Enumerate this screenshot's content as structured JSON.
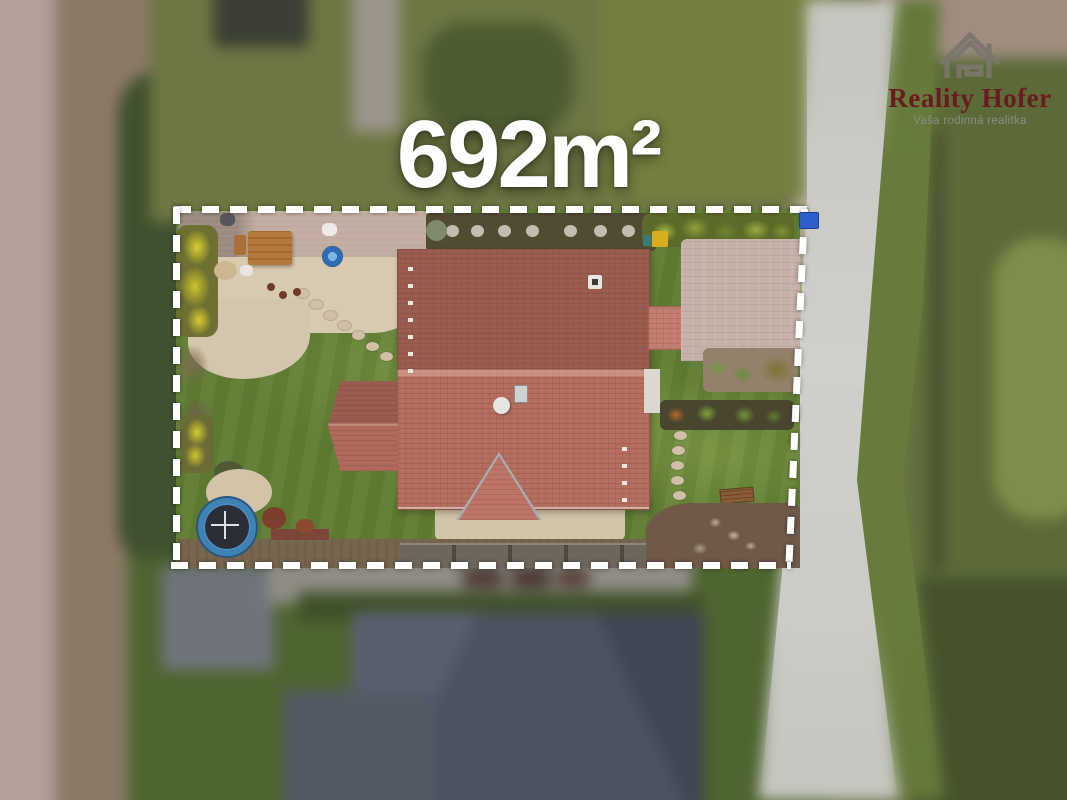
{
  "overlay": {
    "area_label": "692m²"
  },
  "logo": {
    "brand": "Reality Hofer",
    "tagline": "Vaša rodinná realitka",
    "icon": "house-logo-icon"
  },
  "boundary": {
    "style": "dashed",
    "shape": "rectangle"
  },
  "colors": {
    "boundary": "#ffffff",
    "label_text": "#ffffff",
    "brand_text": "#6b1b20",
    "tagline_text": "#8d8a84",
    "logo_icon": "#7c766d",
    "road": "#cac9c4",
    "lawn": "#5f7c33",
    "roof_main": "#b66e60",
    "patio": "#c2aca1",
    "gravel": "#d8cab0",
    "soil": "#6f5948",
    "trampoline_rim": "#3f83b5",
    "hot_tub": "#2e6db3",
    "forsythia": "#d9d02f",
    "mailbox": "#2d5ec9"
  }
}
